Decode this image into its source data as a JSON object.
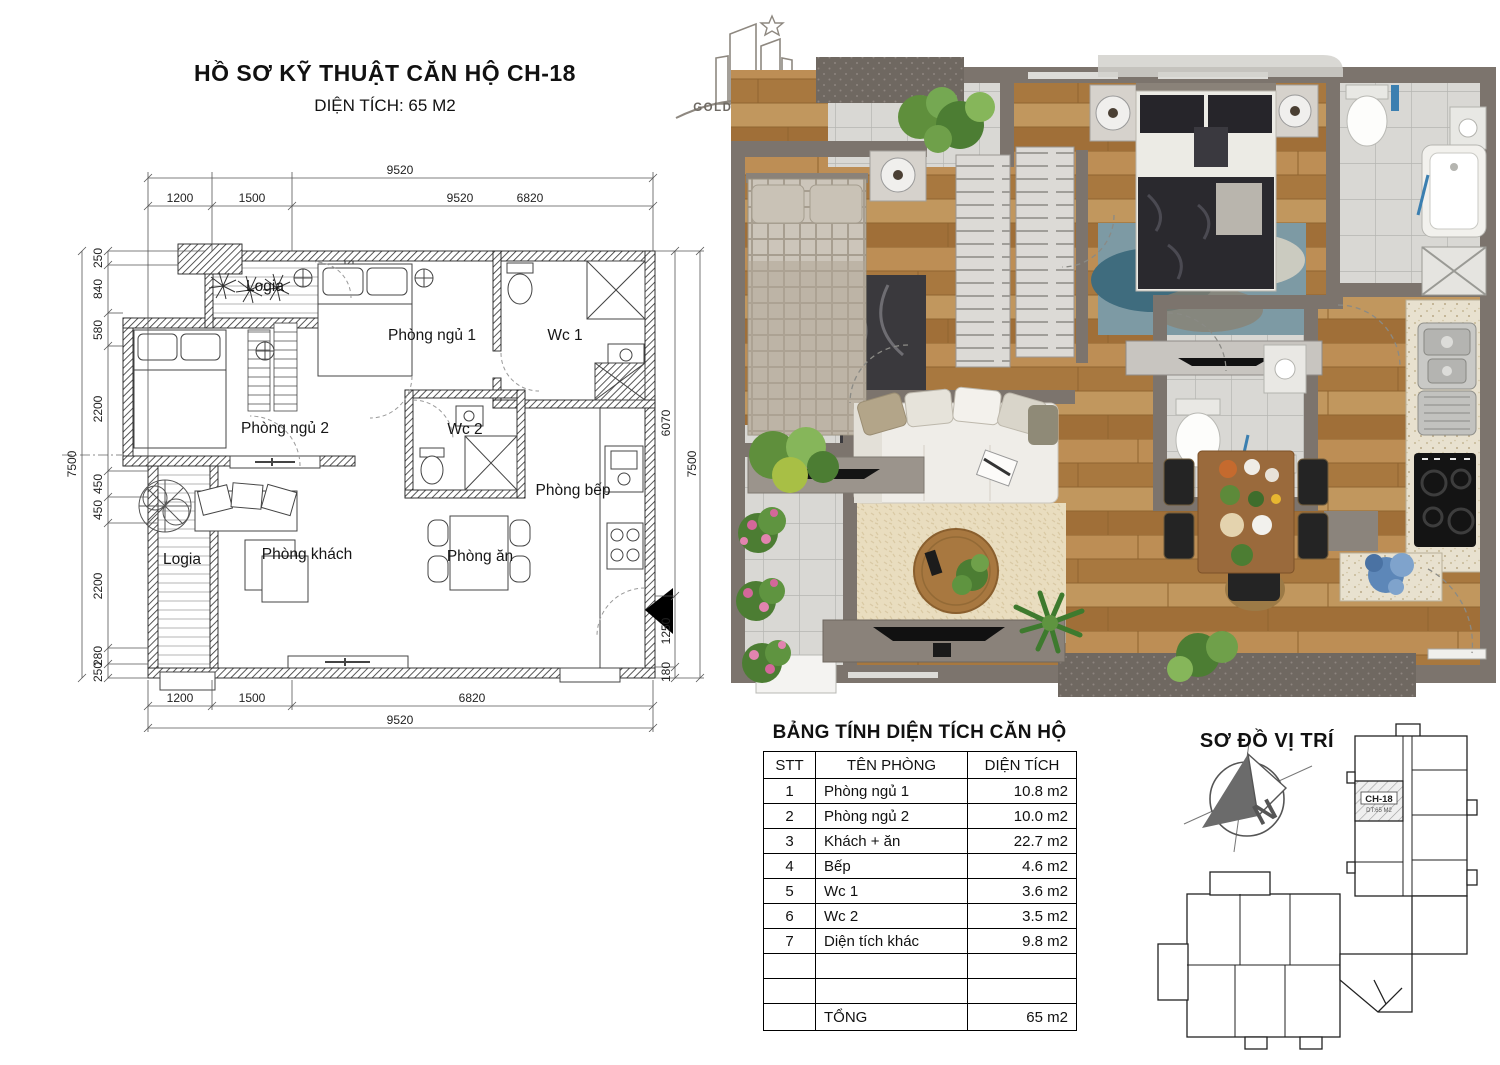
{
  "header": {
    "title": "HỒ SƠ KỸ THUẬT CĂN HỘ CH-18",
    "subtitle": "DIỆN TÍCH: 65 M2"
  },
  "logo": {
    "name": "GOLDEN FIELD"
  },
  "technical_plan": {
    "rooms": {
      "logia_top": "Logia",
      "bedroom1": "Phòng ngủ 1",
      "wc1": "Wc 1",
      "bedroom2": "Phòng ngủ 2",
      "wc2": "Wc 2",
      "kitchen": "Phòng bếp",
      "logia_bottom": "Logia",
      "living": "Phòng khách",
      "dining": "Phòng ăn"
    },
    "dims_top_total": "9520",
    "dims_top": [
      "1200",
      "1500",
      "9520",
      "6820"
    ],
    "dims_bottom": [
      "1200",
      "1500",
      "6820"
    ],
    "dims_bottom_total": "9520",
    "dims_left": [
      "250",
      "840",
      "580",
      "2200",
      "450",
      "450",
      "2200",
      "280",
      "250"
    ],
    "dims_left_total": "7500",
    "dims_right": [
      "6070",
      "7500",
      "1250",
      "180"
    ]
  },
  "area_table": {
    "title": "BẢNG TÍNH DIỆN TÍCH CĂN HỘ",
    "headers": [
      "STT",
      "TÊN PHÒNG",
      "DIỆN TÍCH"
    ],
    "rows": [
      [
        "1",
        "Phòng ngủ 1",
        "10.8 m2"
      ],
      [
        "2",
        "Phòng ngủ 2",
        "10.0 m2"
      ],
      [
        "3",
        "Khách + ăn",
        "22.7 m2"
      ],
      [
        "4",
        "Bếp",
        "4.6 m2"
      ],
      [
        "5",
        "Wc 1",
        "3.6 m2"
      ],
      [
        "6",
        "Wc 2",
        "3.5 m2"
      ],
      [
        "7",
        "Diện tích khác",
        "9.8 m2"
      ],
      [
        "",
        "",
        ""
      ],
      [
        "",
        "",
        ""
      ]
    ],
    "total_label": "TỔNG",
    "total_value": "65 m2"
  },
  "location_map": {
    "title": "SƠ ĐỒ VỊ TRÍ",
    "unit_label": "CH-18",
    "unit_sub": "DT:65 M2",
    "compass_letter": "N"
  },
  "colors": {
    "wall_render": "#7c746d",
    "wood_floor": "#b5834a",
    "tile": "#dbdad6",
    "counter": "#e8e1cf",
    "accent_blue": "#3b7fb0",
    "plant_green": "#5f8f3c",
    "flower_pink": "#d4679a"
  }
}
